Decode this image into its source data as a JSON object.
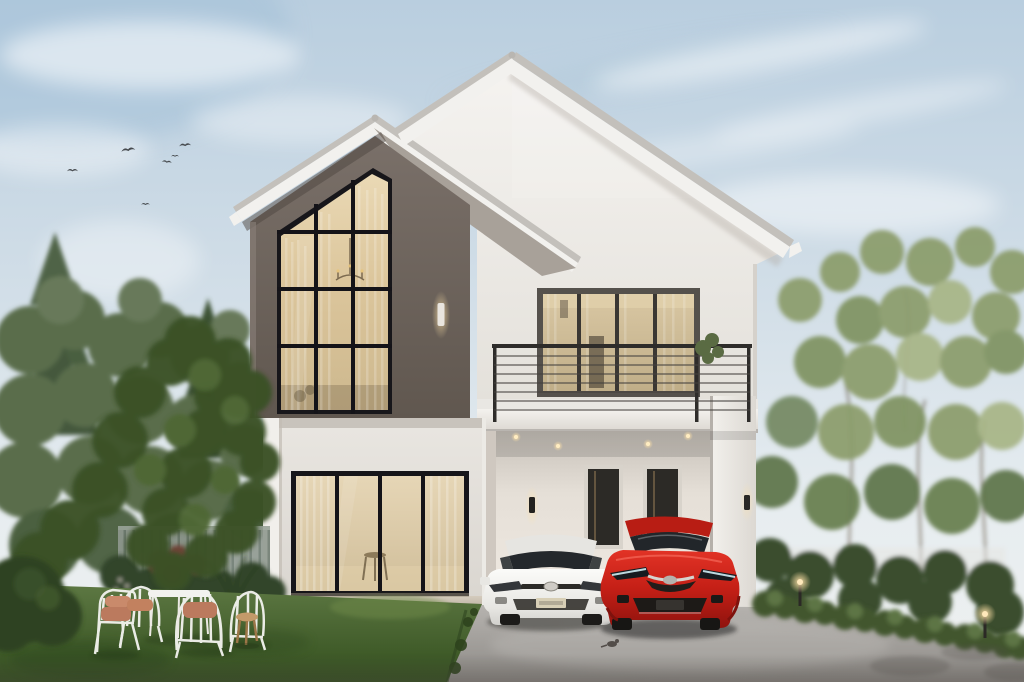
{
  "scene": {
    "title": "Modern two-story house exterior rendering at dusk",
    "setting": "residential front yard at dusk",
    "subjects": [
      "gabled two-story house",
      "white sedan",
      "red hatchback",
      "front lawn with garden furniture",
      "trees",
      "flying birds"
    ]
  },
  "palette": {
    "sky_top": "#b9cedf",
    "sky_horizon": "#eef0ef",
    "cloud": "#ffffff",
    "roof_tile": "#c3c0bb",
    "fascia": "#f2f1ee",
    "gable_wall": "#efece8",
    "accent_wall": "#6f665f",
    "ground_wall": "#e3dfda",
    "window_frame": "#17161a",
    "glass_warm": "#dcc69c",
    "railing": "#2e2c2a",
    "balcony_slab": "#f0eeea",
    "plinth": "#c7bcab",
    "lawn": "#4a6532",
    "lawn_shadow": "#2e431d",
    "driveway": "#a3a09c",
    "tree_foreground": "#3a5128",
    "tree_background": "#5a6d4c",
    "tree_right": "#8a9c6a",
    "hedge": "#42572f",
    "fence": "#8f9890",
    "car_white": "#e6e5e1",
    "car_red": "#b81d14",
    "cushion": "#bb7a5e",
    "stool_wood": "#c49a6a",
    "sconce_glow": "#f2cf9a",
    "downlight": "#ffedc2",
    "bird": "#474b4f"
  },
  "house": {
    "floors": 2,
    "style": "modern minimalist cross-gable",
    "features": [
      "double-height grid window on dark accent gable",
      "second-floor balcony with cable railing",
      "four-panel sliding glass doors",
      "carport with two entry doors",
      "wall sconces",
      "recessed downlights"
    ]
  },
  "lighting": {
    "wall_sconces": 3,
    "recessed_downlights": 4,
    "garden_path_lights": 2,
    "interior_glow": "warm"
  },
  "vehicles": [
    {
      "type": "sedan",
      "color_name": "white"
    },
    {
      "type": "hatchback",
      "color_name": "red"
    }
  ],
  "garden": {
    "chairs": 4,
    "tables": 1,
    "wooden_stools": 1,
    "cushions": 3,
    "birds_flying": 6,
    "birds_on_driveway": 1,
    "topiary_bushes": 1
  }
}
